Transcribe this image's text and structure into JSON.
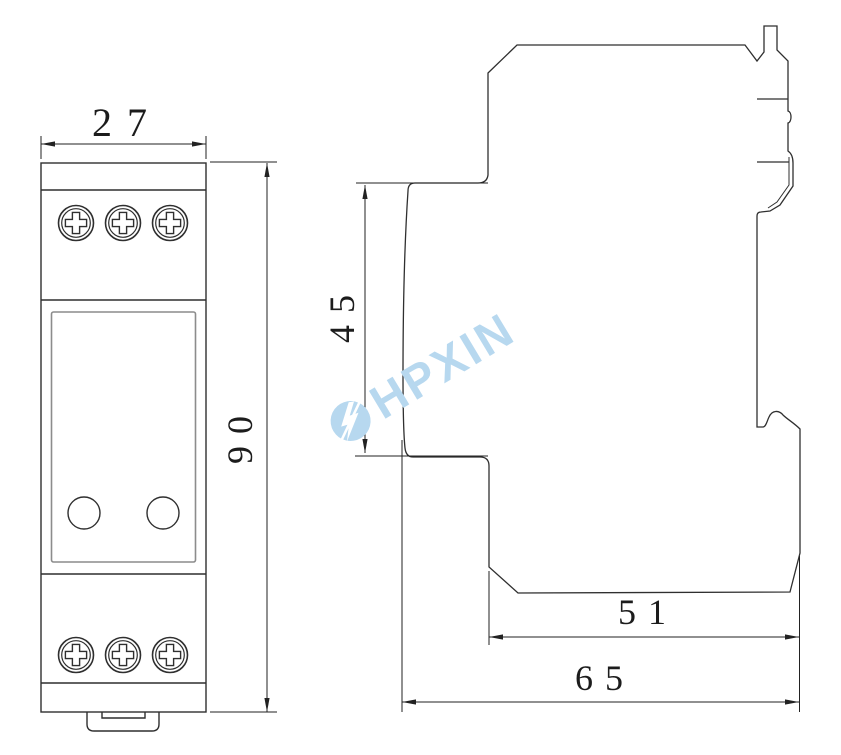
{
  "drawing": {
    "kind": "technical dimension drawing, DIN-rail device (front and side views)",
    "background": "#ffffff",
    "line_color": "#333333"
  },
  "dims": {
    "front_width": "27",
    "front_height": "90",
    "side_upper_height": "45",
    "side_lower_depth": "51",
    "side_total_depth": "65"
  },
  "watermark": {
    "text": "HPXIN",
    "color": "#b7d8ef"
  },
  "icons": {
    "screw": "phillips-screw-icon",
    "indicator": "round-indicator",
    "logo": "hpxin-lightning-logo"
  }
}
